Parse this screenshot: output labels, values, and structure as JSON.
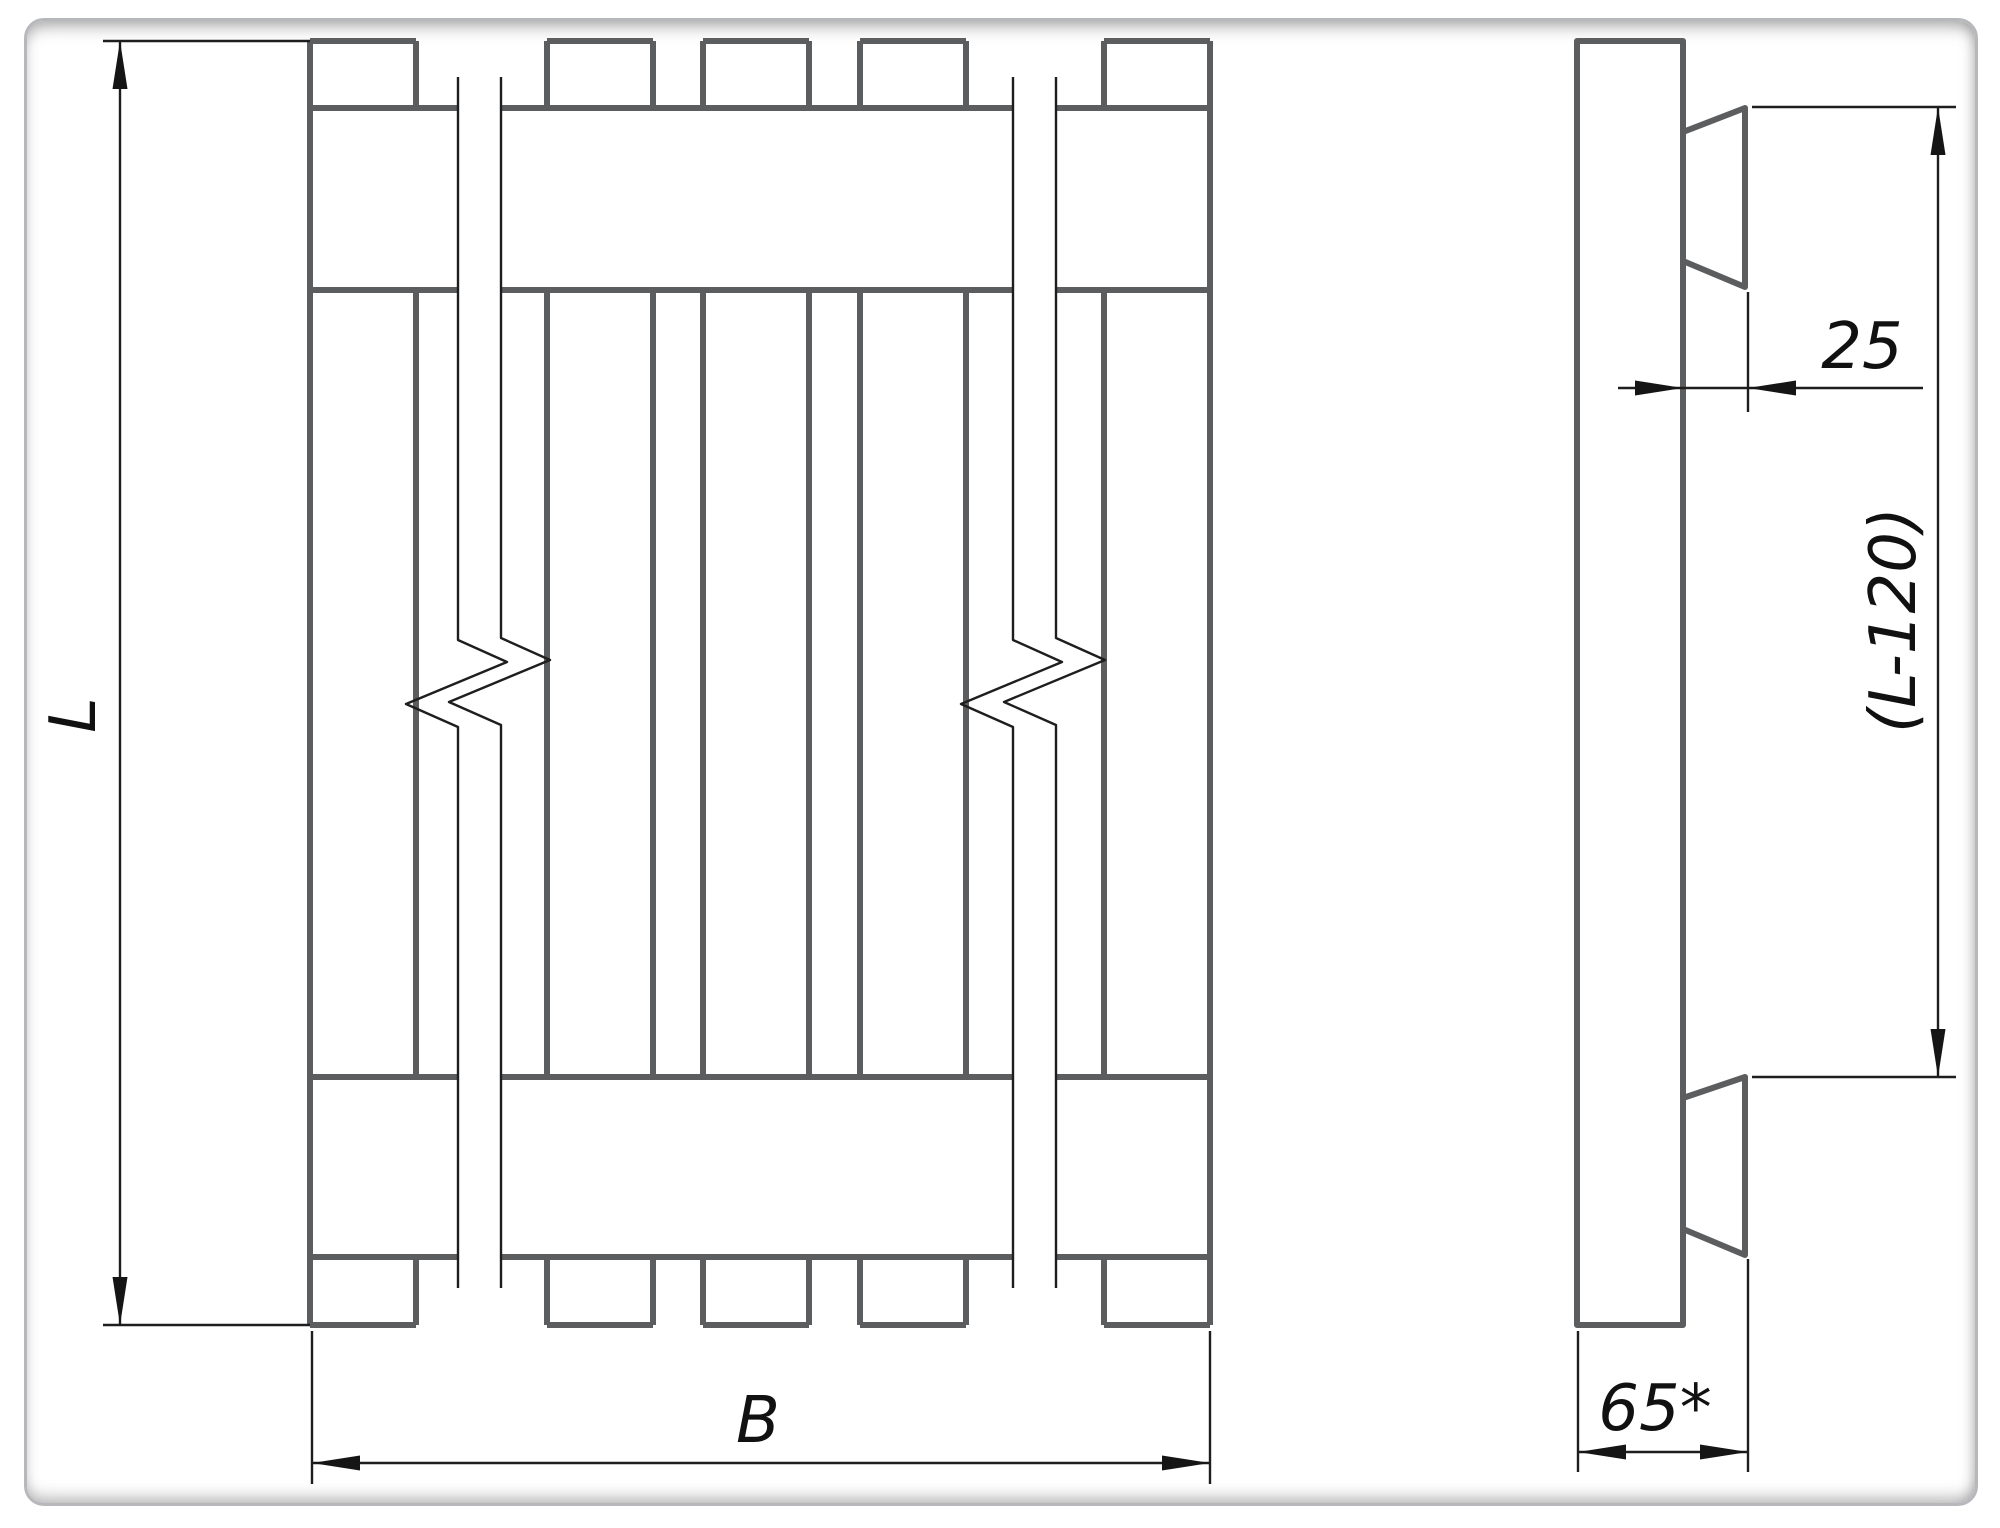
{
  "page": {
    "background": "#ffffff",
    "frame_color": "#b6b8bb"
  },
  "drawing": {
    "type": "pallet technical drawing, front and side views",
    "colors": {
      "object_line": "#5c5d5f",
      "thin_line": "#1e1e1e",
      "text": "#111111"
    },
    "dims": {
      "length": {
        "label": "L"
      },
      "width": {
        "label": "B"
      },
      "cleat_thickness": {
        "label": "25"
      },
      "inner_length": {
        "label": "(L-120)"
      },
      "side_depth": {
        "label": "65*"
      }
    }
  }
}
